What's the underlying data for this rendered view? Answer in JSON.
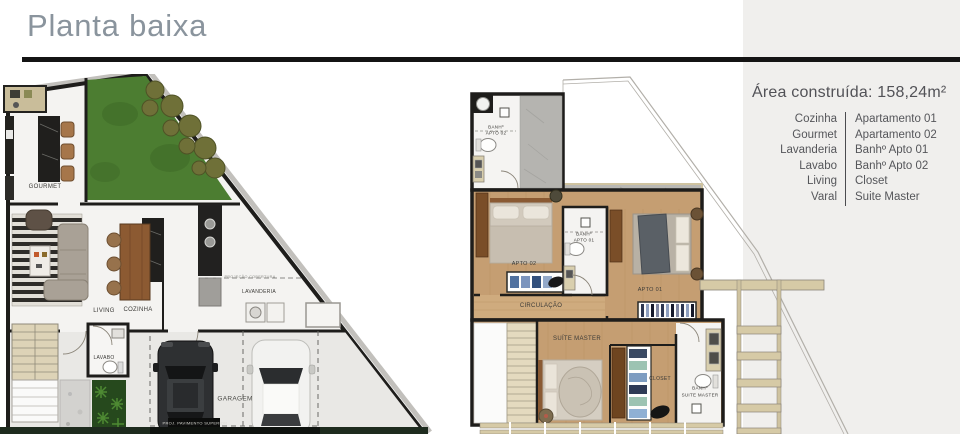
{
  "header": {
    "title": "Planta baixa"
  },
  "legend": {
    "area_label": "Área construída: 158,24m²",
    "rows": [
      {
        "left": "Cozinha",
        "right": "Apartamento 01"
      },
      {
        "left": "Gourmet",
        "right": "Apartamento 02"
      },
      {
        "left": "Lavanderia",
        "right": "Banhº Apto 01"
      },
      {
        "left": "Lavabo",
        "right": "Banhº Apto 02"
      },
      {
        "left": "Living",
        "right": "Closet"
      },
      {
        "left": "Varal",
        "right": "Suite Master"
      }
    ]
  },
  "floorplan_ground": {
    "labels": {
      "gourmet": "GOURMET",
      "living": "LIVING",
      "cozinha": "COZINHA",
      "lavanderia": "LAVANDERIA",
      "projecao": "PROJEÇÃO COBERTURA",
      "lavabo": "LAVABO",
      "garagem": "GARAGEM",
      "proj_pav": "PROJ. PAVIMENTO SUPERIOR"
    }
  },
  "floorplan_upper": {
    "labels": {
      "banh02_l1": "BANHº",
      "banh02_l2": "APTO 02",
      "banh01_l1": "BANHº",
      "banh01_l2": "APTO 01",
      "apto02": "APTO 02",
      "apto01": "APTO 01",
      "circulacao": "CIRCULAÇÃO",
      "suite_master": "SUÍTE MASTER",
      "closet": "CLOSET",
      "banhsuite_l1": "BANHº",
      "banhsuite_l2": "SUITE MASTER"
    }
  },
  "colors": {
    "wall": "#1e1d1b",
    "panel_bg": "#f0efed",
    "title_text": "#8a949d",
    "legend_text": "#55565a",
    "grass": "#4c7d31",
    "wood_floor": "#c59e72",
    "concrete": "#b8b7b3",
    "trim_beige": "#d3c7a4"
  }
}
